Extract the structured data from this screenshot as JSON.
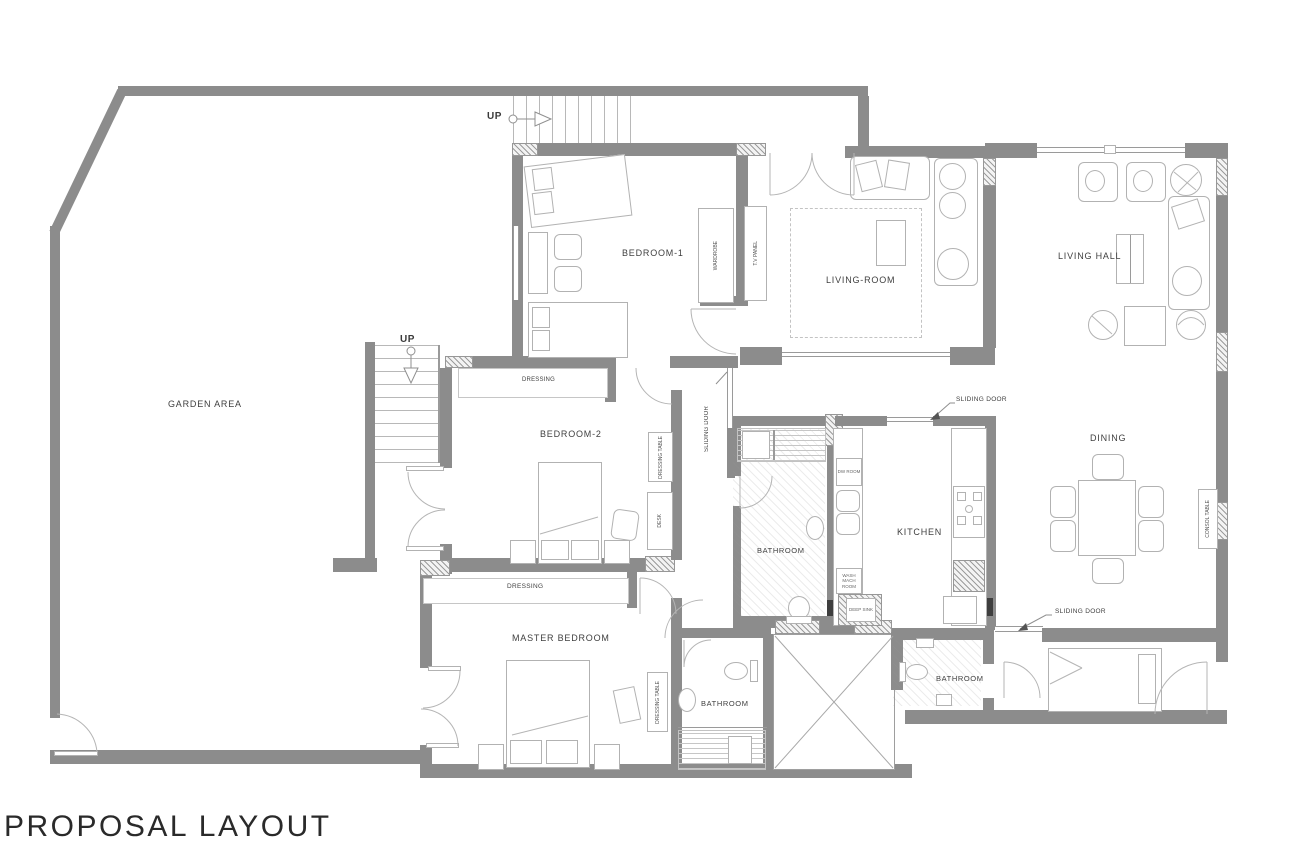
{
  "title": "PROPOSAL LAYOUT",
  "rooms": {
    "garden": "GARDEN AREA",
    "bedroom1": "BEDROOM-1",
    "living_room": "LIVING-ROOM",
    "living_hall": "LIVING HALL",
    "bedroom2": "BEDROOM-2",
    "bathroom_center": "BATHROOM",
    "kitchen": "KITCHEN",
    "dining": "DINING",
    "master_bedroom": "MASTER BEDROOM",
    "bathroom_master": "BATHROOM",
    "bathroom_small": "BATHROOM"
  },
  "labels": {
    "up_top": "UP",
    "up_inner": "UP",
    "dressing_b2": "DRESSING",
    "dressing_master": "DRESSING",
    "dressing_table_b2": "DRESSING TABLE",
    "dressing_table_master": "DRESSING TABLE",
    "desk": "DESK",
    "wardrobe": "WARDROBE",
    "tv_panel": "T.V PANEL",
    "consol_table": "CONSOL TABLE",
    "sliding_door_hall": "SLIDING DOOR",
    "sliding_door_kitchen": "SLIDING DOOR",
    "sliding_door_dining": "SLIDING DOOR",
    "dw_room": "DW ROOM",
    "wash_mach_room": "WASH MACH ROOM",
    "deep_sink": "DEEP SINK"
  },
  "colors": {
    "wall": "#8c8c8c",
    "line": "#b3b3b3",
    "text": "#3f3f3f"
  }
}
